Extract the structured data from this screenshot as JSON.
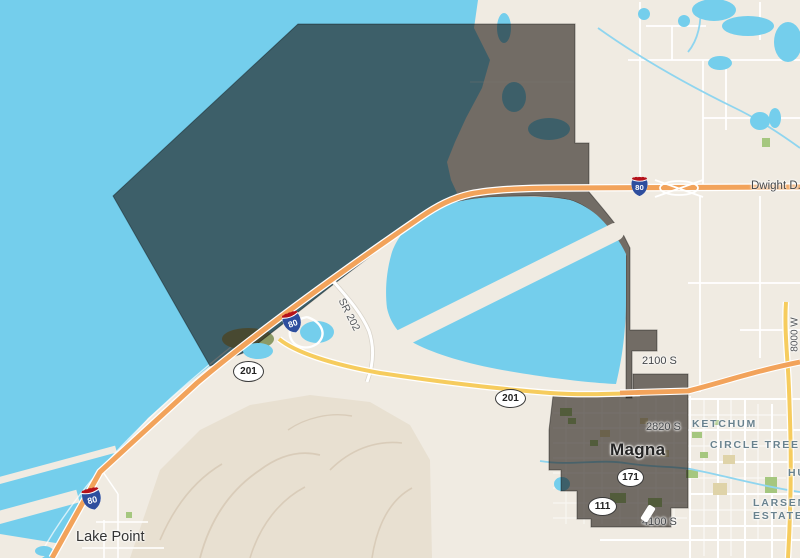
{
  "map": {
    "type": "street-map-with-municipal-boundary-overlay",
    "place_labels": {
      "city": "Magna",
      "town": "Lake Point",
      "neighborhood_1": "KETCHUM",
      "neighborhood_2": "CIRCLE TREE",
      "neighborhood_3_line1": "LARSEN",
      "neighborhood_3_line2": "ESTATES",
      "neighborhood_4_partial": "HU"
    },
    "road_labels": {
      "highway_name": "Dwight D.",
      "sr202": "SR 202",
      "street_2100s": "2100 S",
      "street_2820s": "2820 S",
      "street_4100s": "4100 S",
      "street_8000w": "8000 W"
    },
    "shields": {
      "interstate_80": "80",
      "route_201": "201",
      "route_171": "171",
      "route_111": "111"
    },
    "colors": {
      "water": "#74CEEC",
      "land": "#F0EBE2",
      "hills": "#E8E0D1",
      "road_orange": "#F2A35B",
      "road_yellow": "#F6CC5E",
      "boundary_overlay": "rgba(22,15,10,0.58)",
      "park_green": "#A5C77F",
      "neighborhood_label": "#69828E"
    }
  }
}
